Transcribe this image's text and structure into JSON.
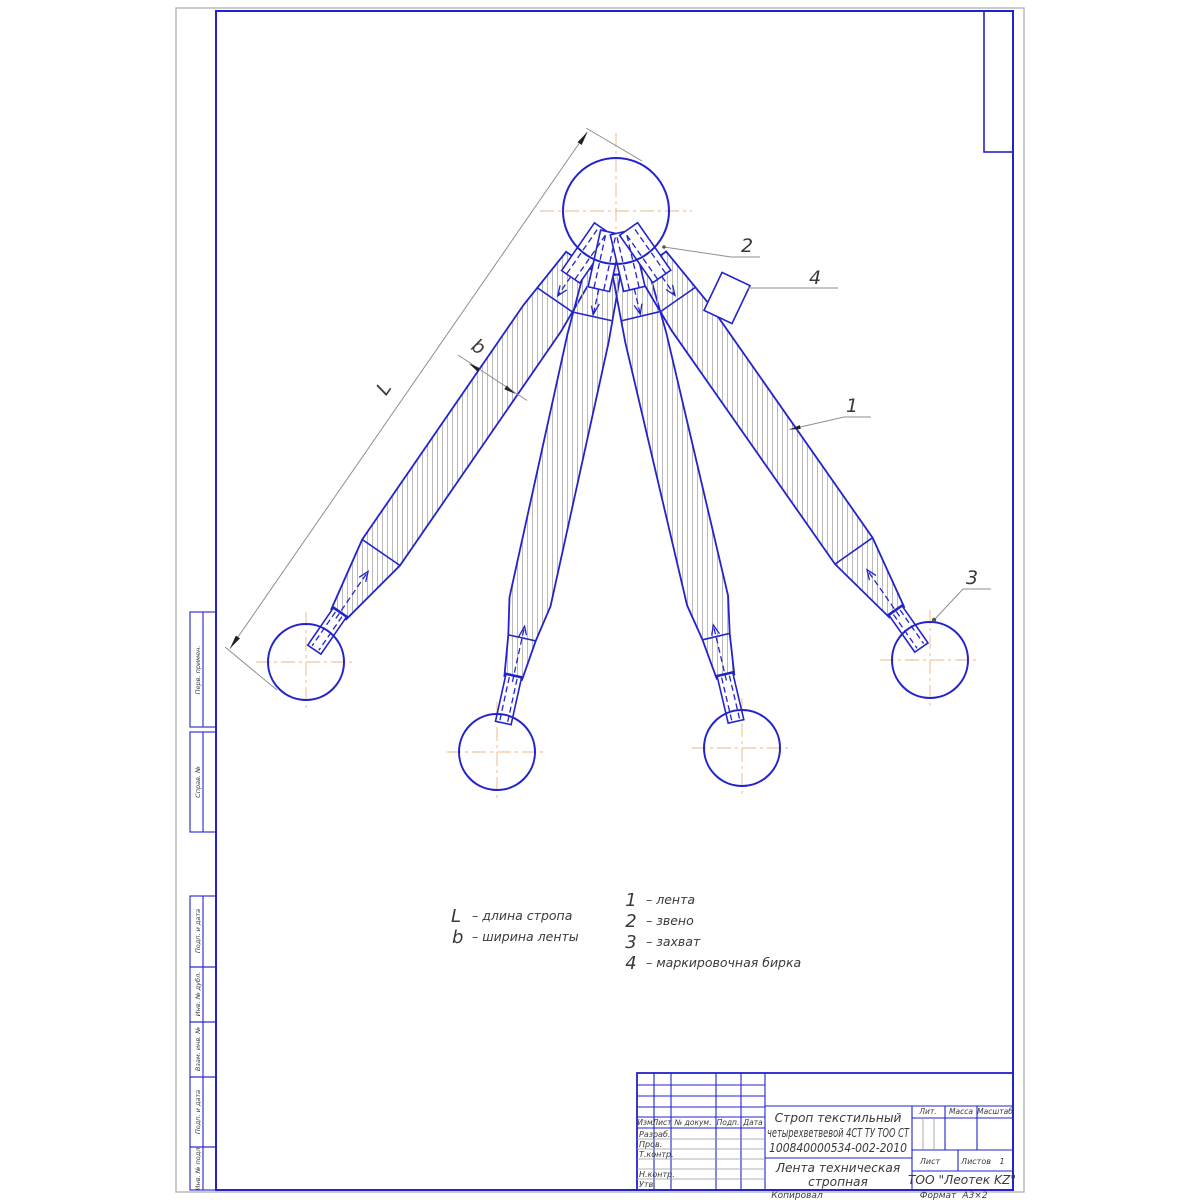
{
  "drawing_labels": {
    "dim_length": "L",
    "dim_width": "b",
    "callout_1": "1",
    "callout_2": "2",
    "callout_3": "3",
    "callout_4": "4"
  },
  "legend": {
    "l_symbol": "L",
    "l_desc": "–  длина стропа",
    "b_symbol": "b",
    "b_desc": "–  ширина ленты",
    "items": [
      {
        "num": "1",
        "desc": "–  лента"
      },
      {
        "num": "2",
        "desc": "–  звено"
      },
      {
        "num": "3",
        "desc": "–  захват"
      },
      {
        "num": "4",
        "desc": "–  маркировочная бирка"
      }
    ]
  },
  "stamp_side": {
    "perv_primen": "Перв. примен.",
    "sprav_no": "Справ. №",
    "podp_data_1": "Подп. и дата",
    "inv_dubl": "Инв. № дубл.",
    "vzam_inv": "Взам. инв. №",
    "podp_data_2": "Подп. и дата",
    "inv_podl": "Инв. № подл."
  },
  "title_block": {
    "rev_header": {
      "izm": "Изм",
      "list": "Лист",
      "doc": "№ докум.",
      "sign": "Подп.",
      "date": "Дата"
    },
    "roles": {
      "developed": "Разраб.",
      "checked": "Пров.",
      "tcontrol": "Т.контр.",
      "ncontrol": "Н.контр.",
      "approved": "Утв."
    },
    "designation_line1": "Строп текстильный",
    "designation_line2": "четырехветвевой 4СТ ТУ ТОО СТ",
    "designation_line3": "100840000534-002-2010",
    "doc_name_line1": "Лента техническая",
    "doc_name_line2": "стропная",
    "lit_label": "Лит.",
    "mass_label": "Масса",
    "scale_label": "Масштаб",
    "sheet_label": "Лист",
    "sheets_label": "Листов",
    "sheets_value": "1",
    "company": "ТОО \"Леотек KZ\"",
    "copied_label": "Копировал",
    "format_label": "Формат",
    "format_value": "А3×2"
  },
  "colors": {
    "line_blue": "#2323cc",
    "centerline_orange": "#eec79b",
    "thin_gray": "#8f8f8f"
  }
}
